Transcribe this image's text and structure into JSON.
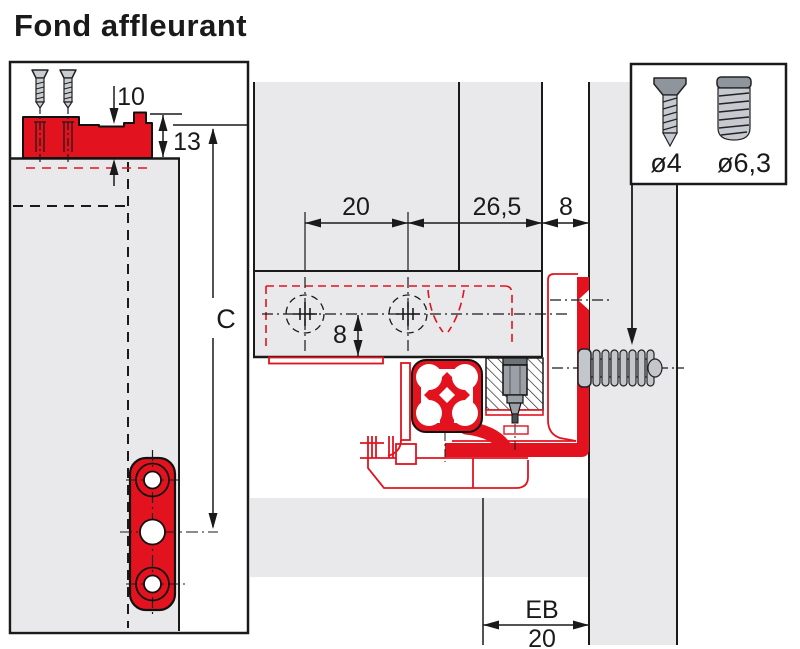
{
  "title": "Fond affleurant",
  "colors": {
    "accent_red": "#e2131f",
    "panel_gray": "#e9e9eb",
    "line_black": "#1a1a1a"
  },
  "left_view": {
    "dim_top_offset": "10",
    "dim_fitting_height": "13",
    "dim_drilling_distance": "C"
  },
  "main_view": {
    "dim_hole_spacing": "20",
    "dim_back_offset": "26,5",
    "dim_wall_gap": "8",
    "dim_drill_depth": "8",
    "dim_eb_label": "EB",
    "dim_eb_value": "20"
  },
  "screw_box": {
    "screw_small_label": "ø4",
    "screw_large_label": "ø6,3"
  }
}
